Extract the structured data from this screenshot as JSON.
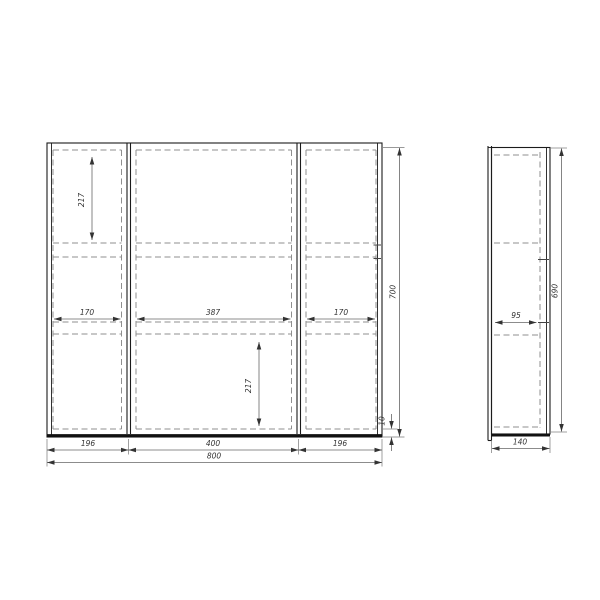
{
  "colors": {
    "background": "#ffffff",
    "structural_line": "#1b1b1b",
    "dashed_line": "#8f8f8f",
    "dimension_line": "#666666",
    "dimension_text": "#333333"
  },
  "front_view": {
    "dims": {
      "inner_height_top_left": "217",
      "inner_height_bottom_middle": "217",
      "inner_width_left": "170",
      "inner_width_middle": "387",
      "inner_width_right": "170",
      "section_width_left": "196",
      "section_width_middle": "400",
      "section_width_right": "196",
      "total_width": "800",
      "total_height": "700",
      "bottom_offset": "10"
    }
  },
  "side_view": {
    "dims": {
      "shelf_depth": "95",
      "door_height": "690",
      "total_depth": "140"
    }
  }
}
